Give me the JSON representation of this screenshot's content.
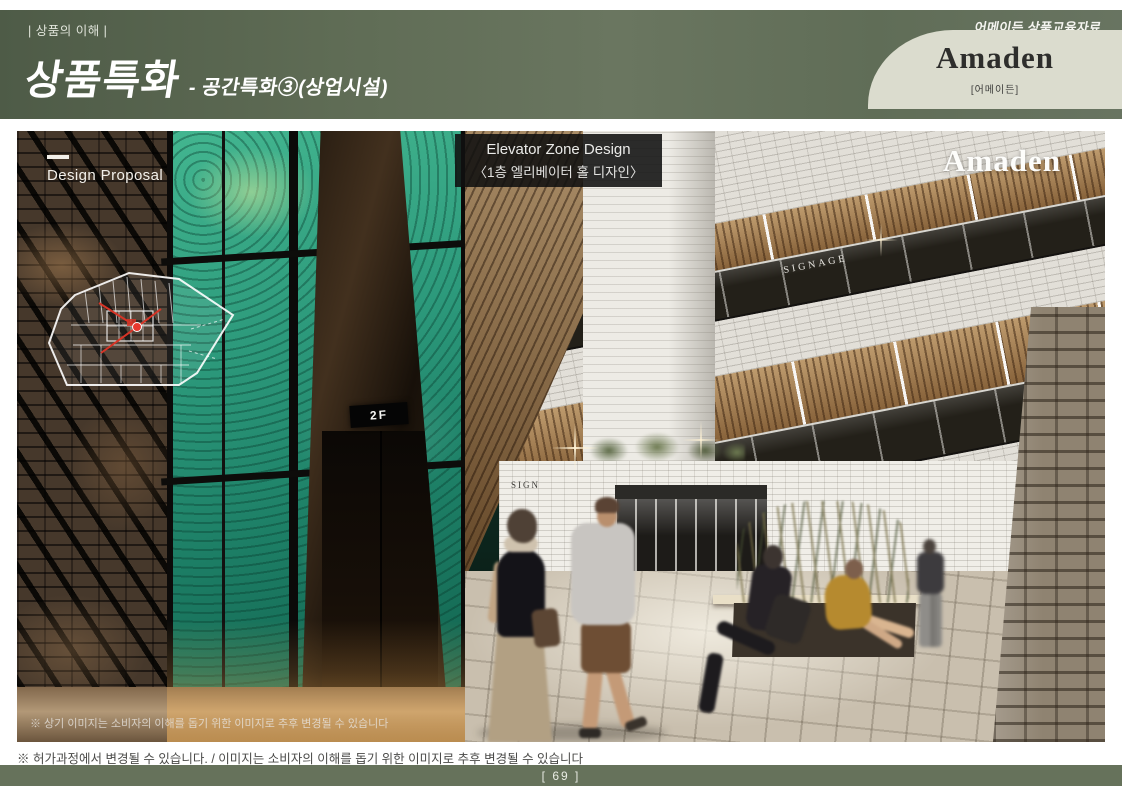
{
  "header": {
    "section_label": "| 상품의 이해 |",
    "doc_type": "어메이든 상품교육자료",
    "title": "상품특화",
    "subtitle": "- 공간특화③(상업시설)",
    "brand": {
      "name": "Amaden",
      "korean_name": "[어메이든]"
    }
  },
  "hero": {
    "design_proposal_label": "Design Proposal",
    "elevator_label": {
      "line1": "Elevator Zone Design",
      "line2": "〈1층 엘리베이터 홀 디자인〉"
    },
    "brand_watermark": "Amaden",
    "elevator_floor_sign": "2F",
    "signage_upper": "SIGNAGE",
    "signage_storefront": "SIGN",
    "inner_disclaimer": "※ 상기 이미지는 소비자의 이해를 돕기 위한 이미지로 추후 변경될 수 있습니다"
  },
  "footer": {
    "disclaimer": "※ 허가과정에서 변경될 수 있습니다. / 이미지는 소비자의 이해를 돕기 위한 이미지로 추후 변경될 수 있습니다",
    "page_number": "[ 69 ]"
  },
  "colors": {
    "band_green": "#66725B",
    "band_green_dark": "#4E5B47",
    "plate_cream": "#DBDCCE",
    "glass_teal": "#2E9C7C",
    "accent_red": "#D63426"
  }
}
